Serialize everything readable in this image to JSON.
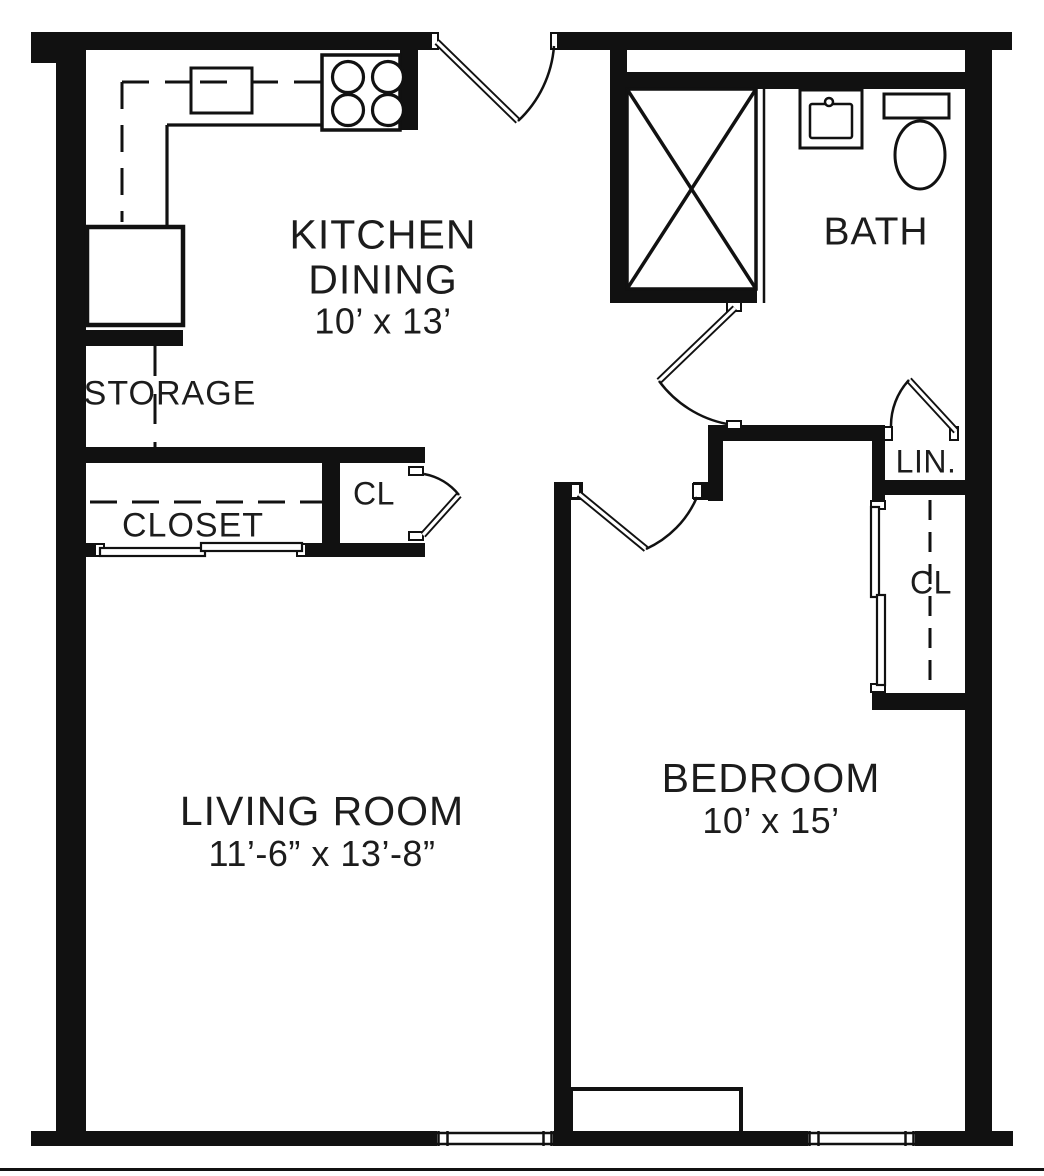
{
  "title": "One-bedroom apartment floor plan",
  "colors": {
    "wall": "#111111",
    "floor": "#ffffff",
    "text": "#1c1c1c"
  },
  "rooms": {
    "kitchen": {
      "name_line1": "KITCHEN",
      "name_line2": "DINING",
      "dims": "10’ x 13’"
    },
    "bath": {
      "name": "BATH"
    },
    "storage": {
      "name": "STORAGE"
    },
    "closet": {
      "name": "CLOSET"
    },
    "entry_closet": {
      "name": "CL"
    },
    "linen_closet": {
      "name": "LIN."
    },
    "bedroom_closet": {
      "name": "CL"
    },
    "living_room": {
      "name": "LIVING ROOM",
      "dims": "11’-6” x 13’-8”"
    },
    "bedroom": {
      "name": "BEDROOM",
      "dims": "10’ x 15’"
    }
  },
  "fixtures": [
    "stove-icon",
    "kitchen-sink-icon",
    "refrigerator-icon",
    "shower-icon",
    "bathroom-sink-icon",
    "toilet-icon"
  ]
}
